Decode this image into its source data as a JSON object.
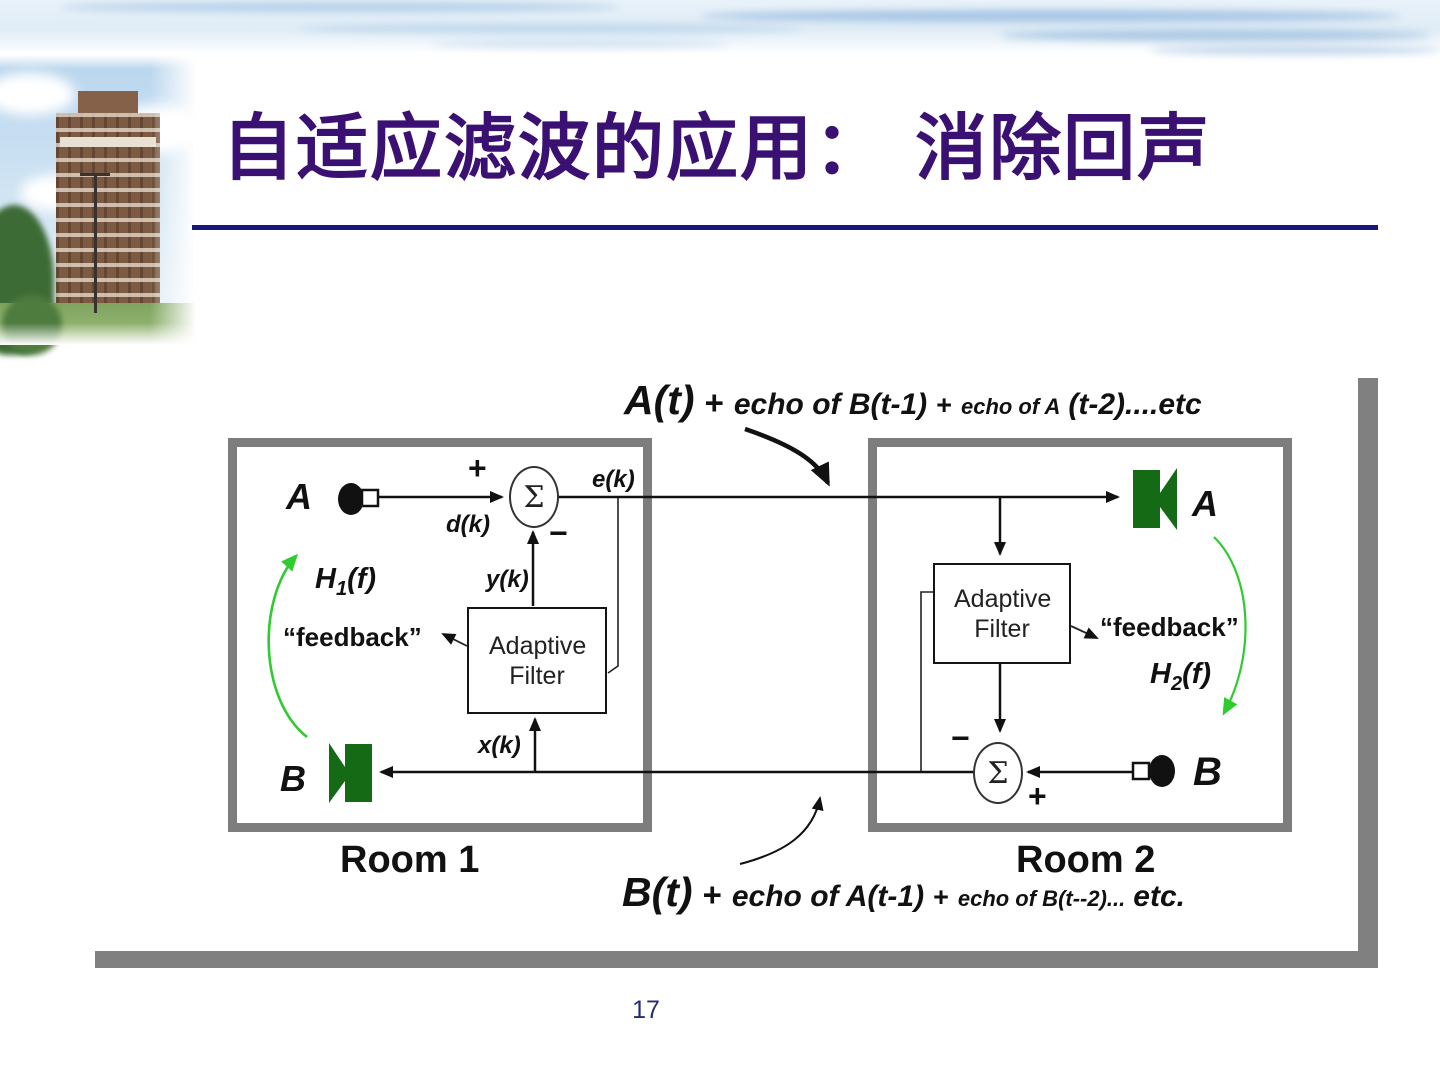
{
  "slide": {
    "title": "自适应滤波的应用： 消除回声",
    "page_number": "17"
  },
  "colors": {
    "title_text": "#3a1173",
    "title_underline": "#17177f",
    "purple_panel": "#a9a9e2",
    "room_border": "#7d7d7d",
    "frame_bar": "#808080",
    "speaker_green": "#156b15",
    "acoustic_arrow_green": "#2ecc2e",
    "page_number": "#232a7c"
  },
  "diagram": {
    "top_annotation": {
      "main": "A(t)",
      "plus1": "+",
      "part2": "echo of B(t-1)",
      "plus2": "+",
      "part3": "echo of A",
      "part4": "(t-2)....etc"
    },
    "bottom_annotation": {
      "main": "B(t)",
      "plus1": "+",
      "part2": "echo of A(t-1)",
      "plus2": "+",
      "part3": "echo of B(t--2)...",
      "part4": "etc."
    },
    "room1": {
      "label": "Room 1",
      "mic_label": "A",
      "speaker_label": "B",
      "sum_symbol": "Σ",
      "plus_sign": "+",
      "minus_sign": "−",
      "e_label": "e(k)",
      "d_label": "d(k)",
      "y_label": "y(k)",
      "x_label": "x(k)",
      "filter_label": "Adaptive Filter",
      "feedback_label": "“feedback”",
      "transfer": {
        "base": "H",
        "sub": "1",
        "rest": "(f)"
      }
    },
    "room2": {
      "label": "Room 2",
      "speaker_label": "A",
      "mic_label": "B",
      "sum_symbol": "Σ",
      "plus_sign": "+",
      "minus_sign": "−",
      "filter_label": "Adaptive Filter",
      "feedback_label": "“feedback”",
      "transfer": {
        "base": "H",
        "sub": "2",
        "rest": "(f)"
      }
    }
  }
}
